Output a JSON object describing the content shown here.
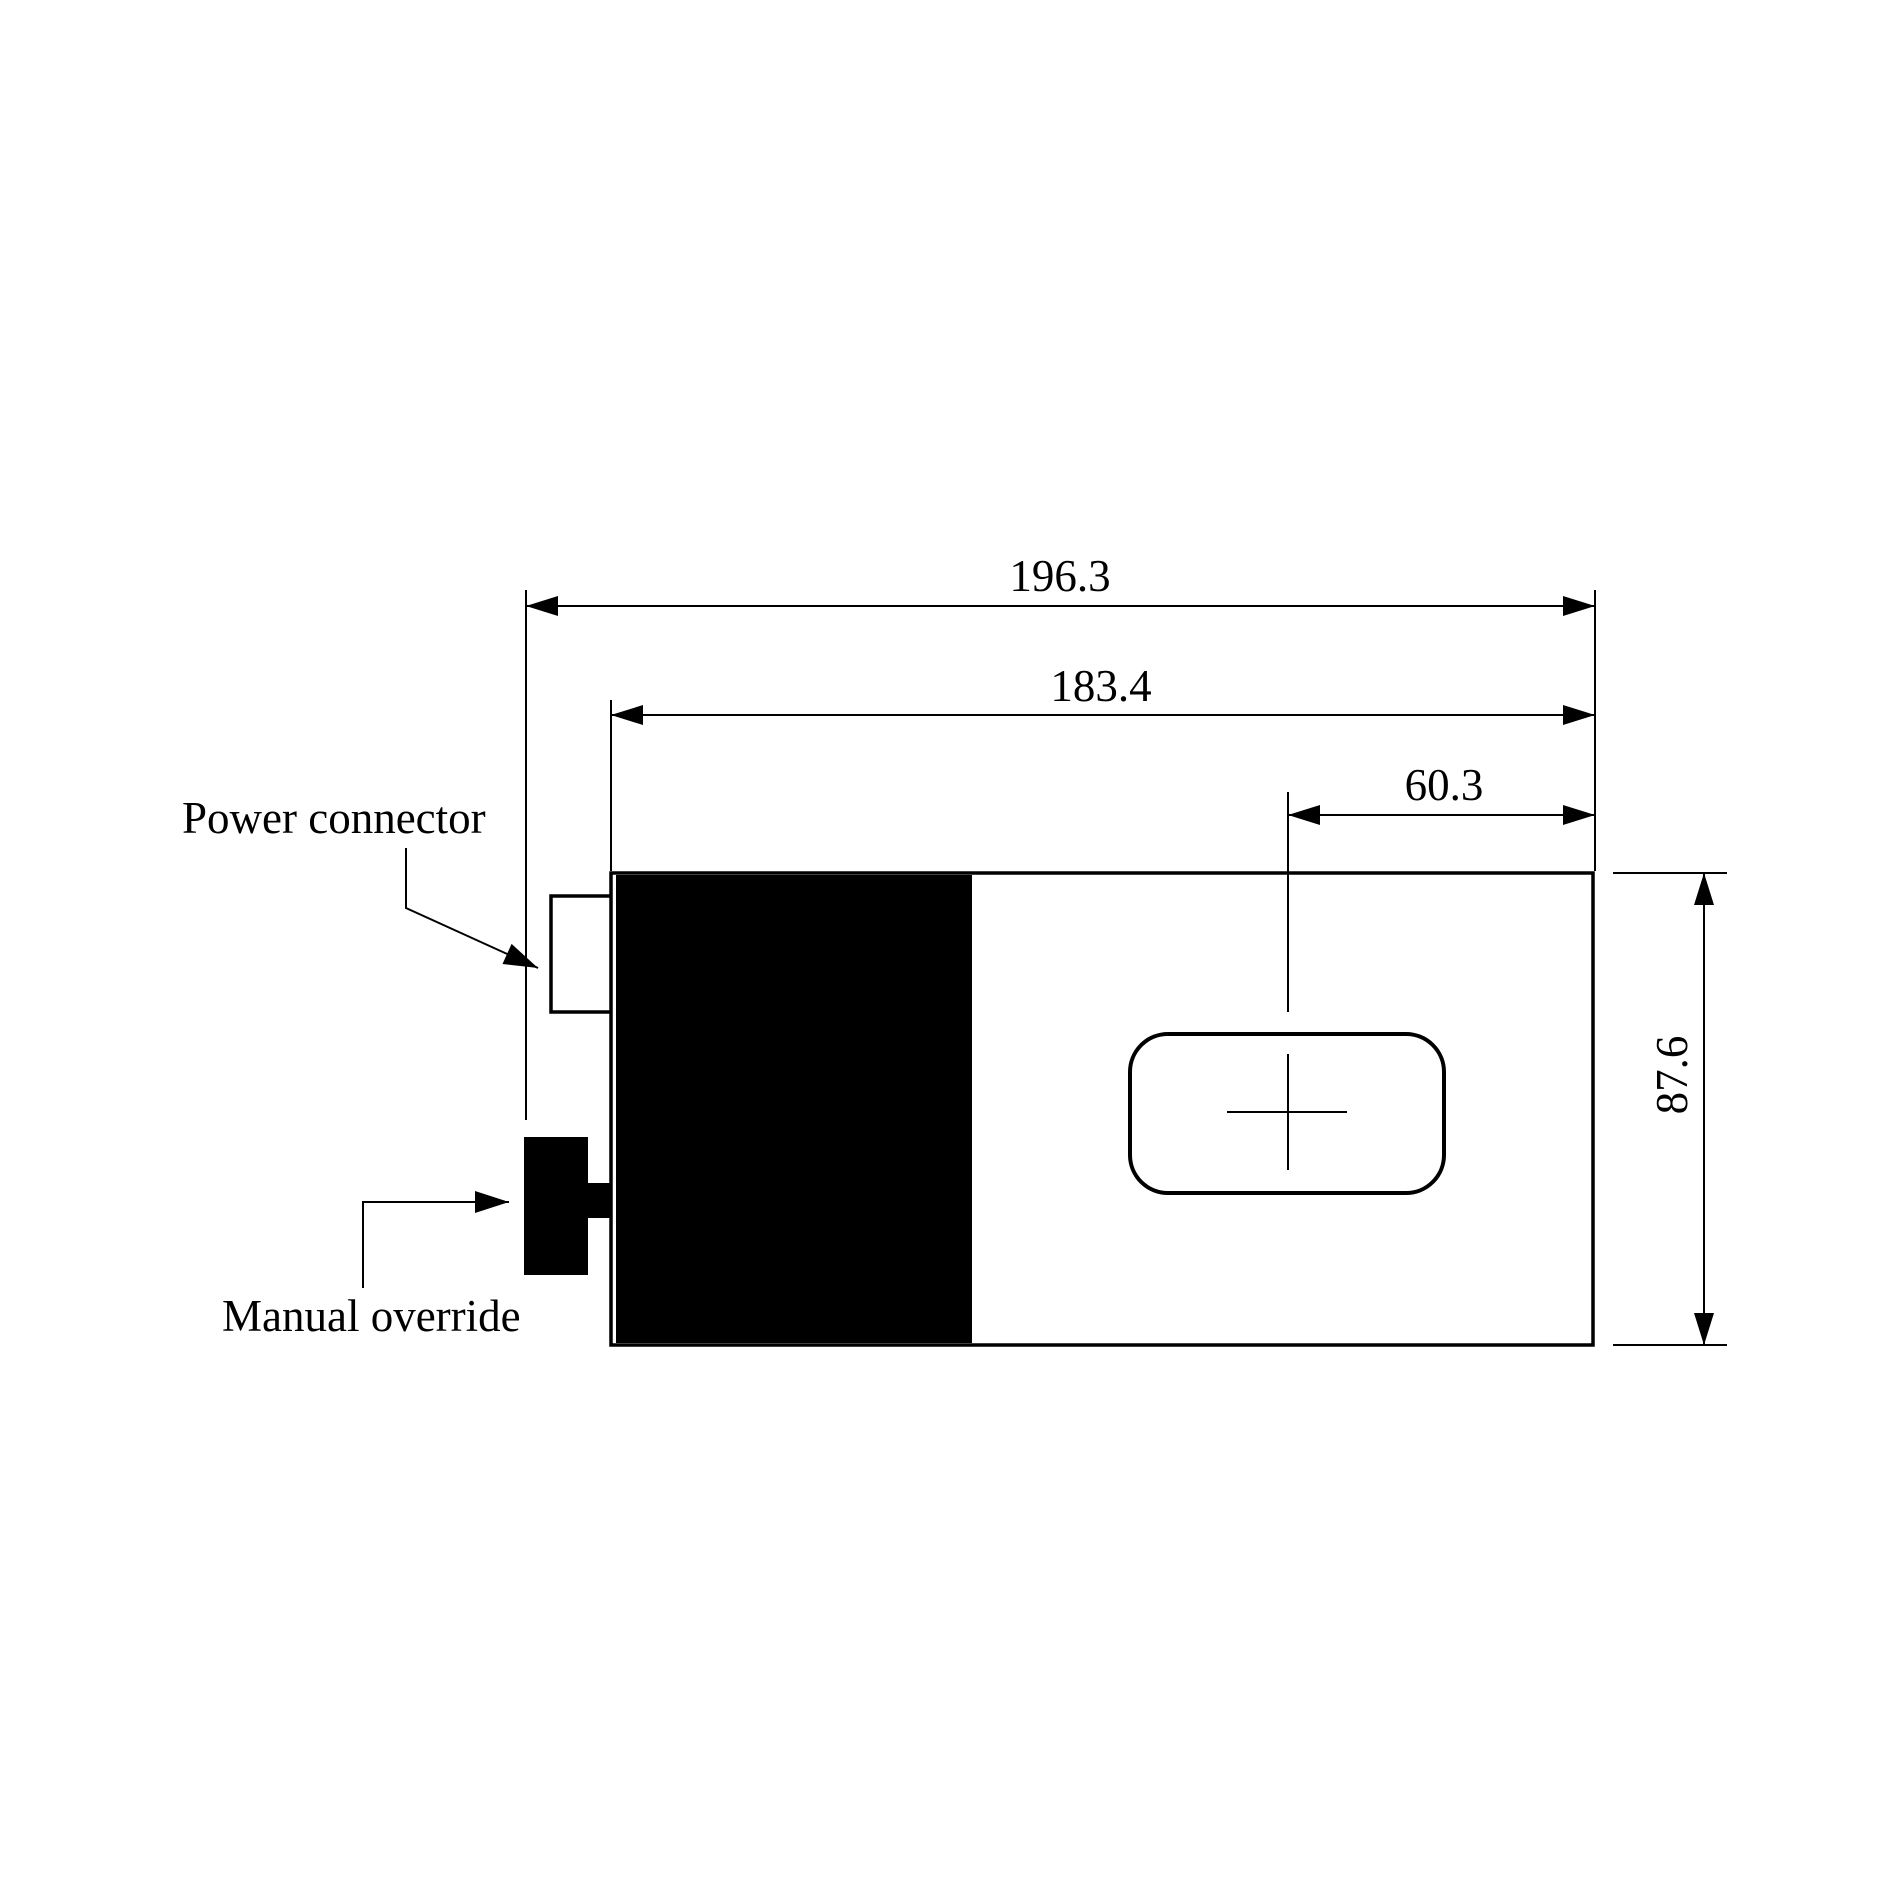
{
  "drawing": {
    "background_color": "#ffffff",
    "stroke_color": "#000000",
    "dimensions": {
      "overall_width": "196.3",
      "body_width": "183.4",
      "center_to_edge": "60.3",
      "body_height": "87.6"
    },
    "callouts": {
      "power_connector": "Power connector",
      "manual_override": "Manual override"
    }
  }
}
